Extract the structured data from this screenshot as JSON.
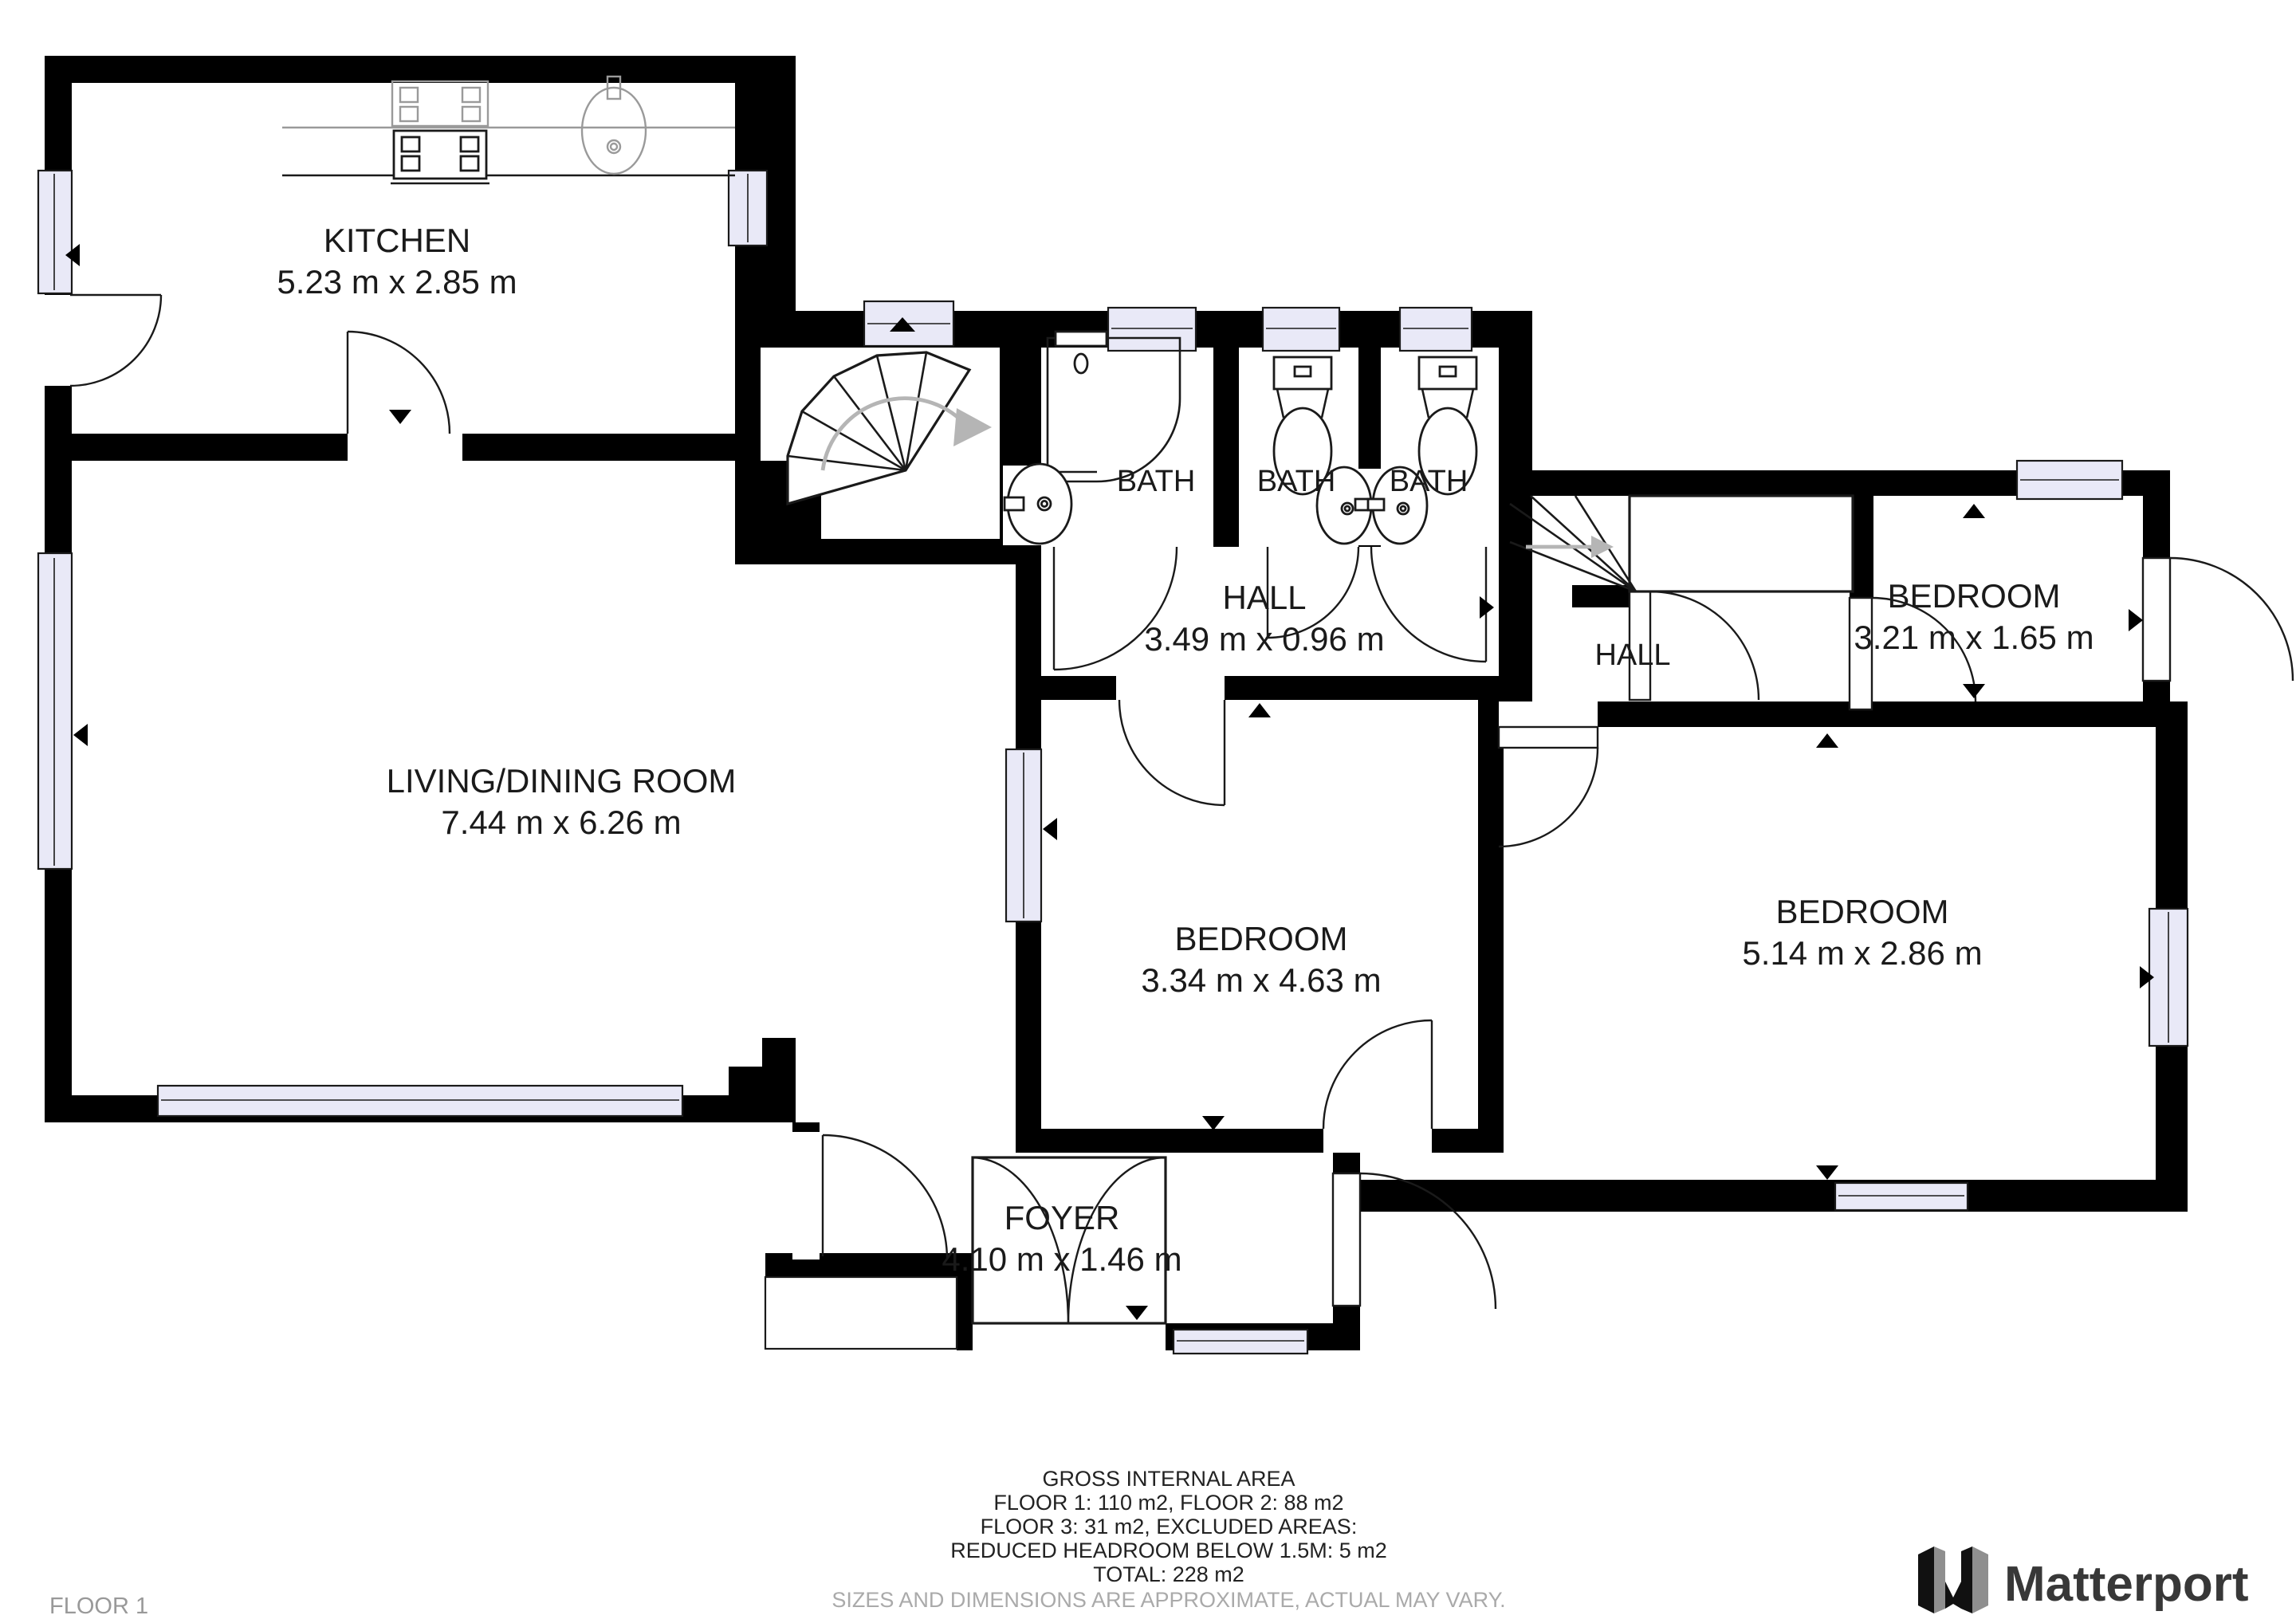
{
  "floor_label": "FLOOR 1",
  "brand": {
    "name": "Matterport"
  },
  "rooms": {
    "kitchen": {
      "name": "KITCHEN",
      "dims": "5.23 m x 2.85 m"
    },
    "living_dining": {
      "name": "LIVING/DINING ROOM",
      "dims": "7.44 m x 6.26 m"
    },
    "bath1": {
      "name": "BATH"
    },
    "bath2": {
      "name": "BATH"
    },
    "bath3": {
      "name": "BATH"
    },
    "hall_top": {
      "name": "HALL",
      "dims": "3.49 m x 0.96 m"
    },
    "hall_right": {
      "name": "HALL"
    },
    "bedroom_top_right": {
      "name": "BEDROOM",
      "dims": "3.21 m x 1.65 m"
    },
    "bedroom_middle": {
      "name": "BEDROOM",
      "dims": "3.34 m x 4.63 m"
    },
    "bedroom_right": {
      "name": "BEDROOM",
      "dims": "5.14 m x 2.86 m"
    },
    "foyer": {
      "name": "FOYER",
      "dims": "4.10 m x 1.46 m"
    }
  },
  "footer": {
    "lines": [
      "GROSS INTERNAL AREA",
      "FLOOR 1: 110 m2, FLOOR 2: 88 m2",
      "FLOOR 3: 31 m2, EXCLUDED AREAS:",
      "REDUCED HEADROOM BELOW 1.5M: 5 m2",
      "TOTAL: 228 m2"
    ],
    "disclaimer": "SIZES AND DIMENSIONS ARE APPROXIMATE, ACTUAL MAY VARY."
  },
  "colors": {
    "wall": "#000000",
    "window_fill": "#e9e9f7",
    "background": "#ffffff",
    "muted_text": "#aaaaaa",
    "brand_text": "#383838"
  }
}
